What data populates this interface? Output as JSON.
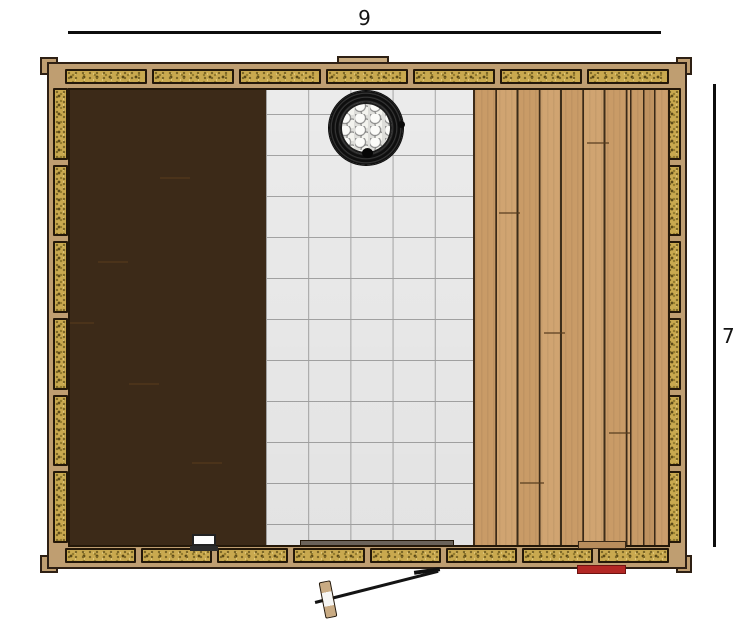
{
  "dimension_labels": {
    "top": "9",
    "right": "7"
  },
  "drawing": {
    "type": "sauna-floor-plan-top-view",
    "regions": [
      "left-wood-deck",
      "center-tile-floor",
      "right-wood-deck"
    ],
    "objects": [
      "stove-with-stones",
      "door-swing-open",
      "vent-notch",
      "door-threshold",
      "white-box",
      "wood-ledge",
      "red-marker"
    ]
  },
  "structure": {
    "insulation_blocks": {
      "top": 7,
      "bottom": 8,
      "left": 6,
      "right": 6
    }
  },
  "colors": {
    "frame_wood": "#bf9e71",
    "insulation": "#c9a94f",
    "plank": "#c99b67",
    "plank_gap": "#3c2a18",
    "tile": "#efefef",
    "grout": "#a6a6a6",
    "stove_rim": "#0e0e0e",
    "stones": "#f3f3ee",
    "red_marker": "#b32724",
    "dimension_line": "#0d0d0d"
  }
}
